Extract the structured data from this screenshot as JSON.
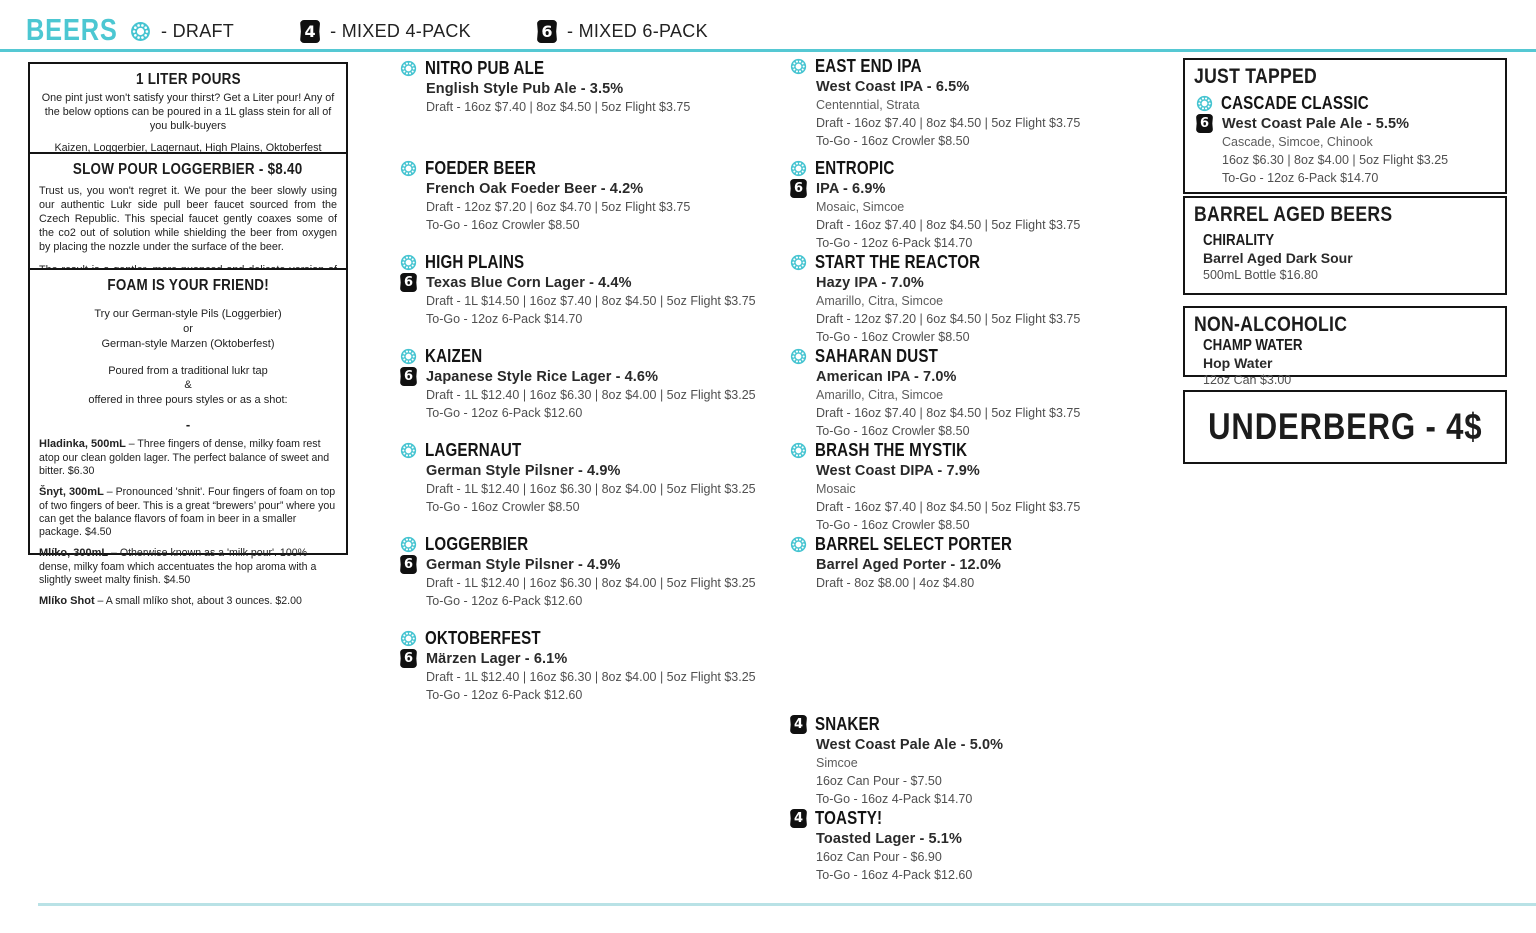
{
  "colors": {
    "accent_teal": "#4cc7d2",
    "rule_light_teal": "#b9e2e6",
    "badge_black": "#101010"
  },
  "badges": {
    "four": "4",
    "six": "6"
  },
  "header": {
    "title": "BEERS",
    "legend": [
      {
        "icon": "draft-icon",
        "label": "- DRAFT"
      },
      {
        "icon": "four-pack-icon",
        "badge": "4",
        "label": "- MIXED 4-PACK"
      },
      {
        "icon": "six-pack-icon",
        "badge": "6",
        "label": "- MIXED 6-PACK"
      }
    ]
  },
  "info_boxes": {
    "liter_pours": {
      "title": "1 LITER POURS",
      "body": "One pint just won't satisfy your thirst? Get a Liter pour! Any of the below options can be poured in a 1L glass stein for all of you bulk-buyers",
      "beers": "Kaizen, Loggerbier, Lagernaut, High Plains, Oktoberfest"
    },
    "slow_pour": {
      "title": "SLOW POUR LOGGERBIER - $8.40",
      "para1": "Trust us, you won't regret it. We pour the beer slowly using our authentic Lukr side pull beer faucet sourced from the Czech Republic. This special faucet gently coaxes some of the co2 out of solution while shielding the beer from oxygen by placing the nozzle under the surface of the beer.",
      "para2": "The result is a gentler, more nuanced and delicate version of the beer that sits under a tall, almost merengue-like head. It is absolutely worth the wait."
    },
    "foam": {
      "title": "FOAM IS YOUR FRIEND!",
      "line1": "Try our German-style Pils (Loggerbier)",
      "line2": "or",
      "line3": "German-style Marzen (Oktoberfest)",
      "line4": "Poured from a traditional lukr tap",
      "line5": "&",
      "line6": "offered in three pours styles or as a shot:",
      "dash": "-",
      "pours": [
        {
          "lead": "Hladinka, 500mL",
          "text": " – Three fingers of dense, milky foam rest atop our clean golden lager. The perfect balance of sweet and bitter. $6.30"
        },
        {
          "lead": "Šnyt, 300mL",
          "text": " – Pronounced 'shnit'. Four fingers of foam on top of two fingers of beer. This is a great “brewers’ pour” where you can get the balance flavors of foam in beer in a smaller package. $4.50"
        },
        {
          "lead": "Mlíko, 300mL",
          "text": " – Otherwise known as a 'milk pour'. 100% dense, milky foam which accentuates the hop aroma with a slightly sweet malty finish. $4.50"
        },
        {
          "lead": "Mlíko Shot",
          "text": " – A small mlíko shot, about 3 ounces. $2.00"
        }
      ]
    }
  },
  "column2": {
    "beers": [
      {
        "name": "NITRO PUB ALE",
        "icons": [
          "draft-icon"
        ],
        "style": "English Style Pub Ale - 3.5%",
        "price1": "Draft - 16oz $7.40 | 8oz $4.50 | 5oz Flight $3.75"
      },
      {
        "name": "FOEDER BEER",
        "icons": [
          "draft-icon"
        ],
        "style": "French Oak Foeder Beer - 4.2%",
        "price1": "Draft - 12oz $7.20  |  6oz $4.70  |  5oz Flight $3.75",
        "price2": "To-Go - 16oz Crowler $8.50"
      },
      {
        "name": "HIGH PLAINS",
        "icons": [
          "draft-icon",
          "six-pack-icon"
        ],
        "style": "Texas Blue Corn Lager - 4.4%",
        "price1": "Draft - 1L $14.50  | 16oz $7.40  |  8oz $4.50  |  5oz Flight $3.75",
        "price2": "To-Go - 12oz 6-Pack $14.70"
      },
      {
        "name": "KAIZEN",
        "icons": [
          "draft-icon",
          "six-pack-icon"
        ],
        "style": "Japanese Style Rice Lager - 4.6%",
        "price1": "Draft - 1L $12.40  | 16oz $6.30  |  8oz $4.00  |  5oz Flight $3.25",
        "price2": "To-Go - 12oz 6-Pack $12.60"
      },
      {
        "name": "LAGERNAUT",
        "icons": [
          "draft-icon"
        ],
        "style": "German Style Pilsner - 4.9%",
        "price1": "Draft - 1L $12.40  | 16oz $6.30  |  8oz $4.00  |  5oz Flight $3.25",
        "price2": "To-Go - 16oz Crowler $8.50"
      },
      {
        "name": "LOGGERBIER",
        "icons": [
          "draft-icon",
          "six-pack-icon"
        ],
        "style": "German Style Pilsner - 4.9%",
        "price1": "Draft - 1L $12.40  | 16oz $6.30  |  8oz $4.00  |  5oz Flight $3.25",
        "price2": "To-Go - 12oz 6-Pack $12.60"
      },
      {
        "name": "OKTOBERFEST",
        "icons": [
          "draft-icon",
          "six-pack-icon"
        ],
        "style": "Märzen Lager - 6.1%",
        "price1": "Draft - 1L $12.40  | 16oz $6.30  |  8oz $4.00  |  5oz Flight $3.25",
        "price2": "To-Go - 12oz 6-Pack $12.60"
      }
    ]
  },
  "column3": {
    "beers": [
      {
        "name": "EAST END IPA",
        "icons": [
          "draft-icon"
        ],
        "style": "West Coast IPA - 6.5%",
        "hops": "Centenntial, Strata",
        "price1": "Draft - 16oz $7.40 | 8oz $4.50 | 5oz Flight $3.75",
        "price2": "To-Go - 16oz Crowler $8.50"
      },
      {
        "name": "ENTROPIC",
        "icons": [
          "draft-icon",
          "six-pack-icon"
        ],
        "style": "IPA - 6.9%",
        "hops": "Mosaic, Simcoe",
        "price1": "Draft - 16oz $7.40 | 8oz $4.50 | 5oz Flight $3.75",
        "price2": "To-Go - 12oz 6-Pack $14.70"
      },
      {
        "name": "START THE REACTOR",
        "icons": [
          "draft-icon"
        ],
        "style": "Hazy IPA - 7.0%",
        "hops": "Amarillo, Citra, Simcoe",
        "price1": "Draft - 12oz $7.20 | 6oz $4.50 | 5oz Flight $3.75",
        "price2": "To-Go - 16oz Crowler $8.50"
      },
      {
        "name": "SAHARAN DUST",
        "icons": [
          "draft-icon"
        ],
        "style": "American IPA - 7.0%",
        "hops": "Amarillo, Citra, Simcoe",
        "price1": "Draft - 16oz $7.40 | 8oz $4.50 | 5oz Flight $3.75",
        "price2": "To-Go - 16oz Crowler $8.50"
      },
      {
        "name": "BRASH THE MYSTIK",
        "icons": [
          "draft-icon"
        ],
        "style": "West Coast DIPA - 7.9%",
        "hops": "Mosaic",
        "price1": "Draft - 16oz $7.40 | 8oz $4.50 | 5oz Flight $3.75",
        "price2": "To-Go - 16oz Crowler $8.50"
      },
      {
        "name": "BARREL SELECT PORTER",
        "icons": [
          "draft-icon"
        ],
        "style": "Barrel Aged Porter - 12.0%",
        "price1": "Draft - 8oz $8.00  |  4oz $4.80"
      },
      {
        "name": "SNAKER",
        "icons": [
          "four-pack-icon"
        ],
        "style": "West Coast Pale Ale - 5.0%",
        "hops": "Simcoe",
        "price1": "16oz Can Pour - $7.50",
        "price2": "To-Go - 16oz 4-Pack $14.70"
      },
      {
        "name": "TOASTY!",
        "icons": [
          "four-pack-icon"
        ],
        "style": "Toasted Lager - 5.1%",
        "price1": "16oz Can Pour - $6.90",
        "price2": "To-Go - 16oz 4-Pack $12.60"
      }
    ]
  },
  "right_boxes": {
    "just_tapped": {
      "title": "JUST TAPPED",
      "beer": {
        "name": "CASCADE CLASSIC",
        "icons": [
          "draft-icon",
          "six-pack-icon"
        ],
        "style": "West Coast Pale Ale - 5.5%",
        "hops": "Cascade, Simcoe, Chinook",
        "price1": "16oz $6.30 | 8oz $4.00 | 5oz Flight $3.25",
        "price2": "To-Go - 12oz 6-Pack $14.70"
      }
    },
    "barrel_aged": {
      "title": "BARREL AGED BEERS",
      "name": "CHIRALITY",
      "style": "Barrel Aged Dark Sour",
      "price": "500mL Bottle $16.80"
    },
    "non_alcoholic": {
      "title": "NON-ALCOHOLIC",
      "name": "CHAMP WATER",
      "style": "Hop Water",
      "price": "12oz Can $3.00"
    },
    "underberg": {
      "title": "UNDERBERG - 4$"
    }
  }
}
